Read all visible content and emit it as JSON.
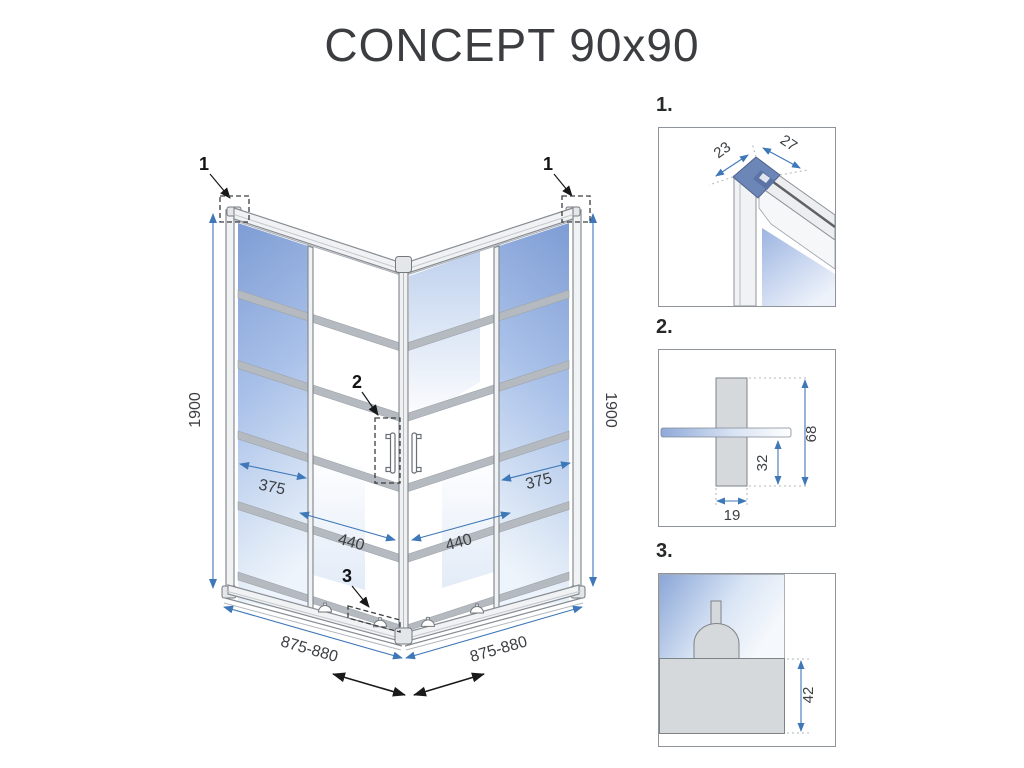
{
  "title": "CONCEPT 90x90",
  "colors": {
    "dimension_blue": "#3f78b8",
    "frame_gray": "#8e949a",
    "glass_blue": "#8fa9d8",
    "glass_light": "#eef4fb",
    "stripe_gray": "#b4bac0",
    "corner_cap_blue": "#6d86b8",
    "detail_part_gray": "#d6d9dc",
    "callout_black": "#111315"
  },
  "main": {
    "callout_top_left": "1",
    "callout_top_right": "1",
    "callout_handle": "2",
    "callout_bottom": "3",
    "dim_height_left": "1900",
    "dim_height_right": "1900",
    "dim_fixed_left": "375",
    "dim_fixed_right": "375",
    "dim_door_left": "440",
    "dim_door_right": "440",
    "dim_width_left": "875-880",
    "dim_width_right": "875-880"
  },
  "details": {
    "d1": {
      "label": "1.",
      "dim_depth": "23",
      "dim_width": "27"
    },
    "d2": {
      "label": "2.",
      "dim_height": "68",
      "dim_offset": "32",
      "dim_width": "19"
    },
    "d3": {
      "label": "3.",
      "dim_height": "42"
    }
  }
}
